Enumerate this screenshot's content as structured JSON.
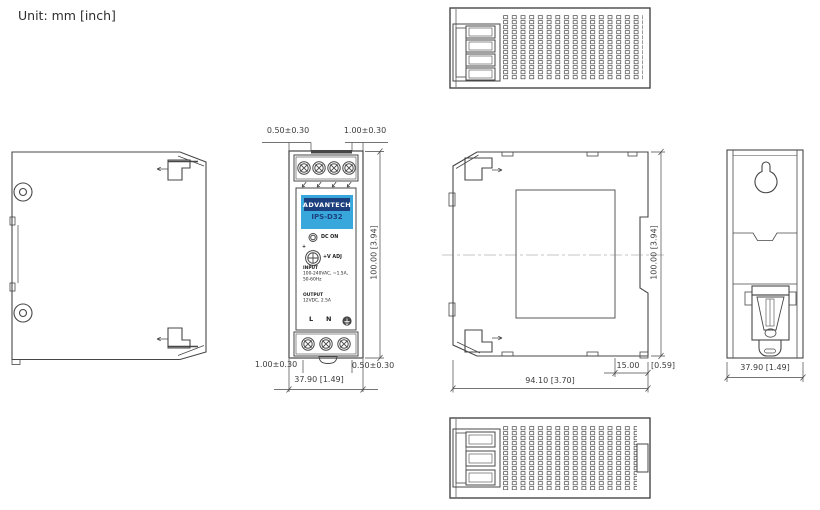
{
  "unit_label": "Unit: mm  [inch]",
  "colors": {
    "line": "#474747",
    "dim_text": "#3c3c3c",
    "label_blue": "#38a8dc",
    "label_navy": "#1c3f7d",
    "logo_text": "#ffffff"
  },
  "front_view": {
    "brand": "ADVANTECH",
    "model": "IPS-D32",
    "led_label": "DC ON",
    "adj_plus": "+",
    "adj_label": "+V ADJ",
    "input_block": {
      "line1": "INPUT",
      "line2": "100-240VAC, ~1.5A,",
      "line3": "50-60Hz"
    },
    "output_block": {
      "line1": "OUTPUT",
      "line2": "12VDC, 2.5A"
    },
    "terminals": {
      "l": "L",
      "n": "N"
    },
    "dims": {
      "top_left": "0.50±0.30",
      "top_right": "1.00±0.30",
      "height": "100.00 [3.94]",
      "bottom_left": "1.00±0.30",
      "bottom_right": "0.50±0.30",
      "width": "37.90 [1.49]"
    }
  },
  "side_view": {
    "dims": {
      "height": "100.00 [3.94]",
      "width": "94.10 [3.70]",
      "din_depth": "15.00",
      "din_depth_inch": "[0.59]"
    }
  },
  "back_view": {
    "dims": {
      "width": "37.90 [1.49]"
    }
  }
}
